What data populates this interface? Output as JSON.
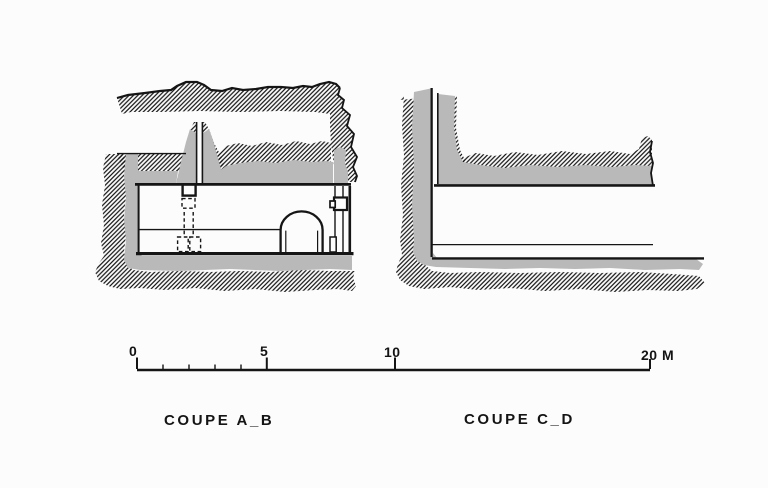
{
  "page": {
    "background": "#fcfcfc",
    "ink_color": "#151515",
    "masonry_gray": "#b9b9b9"
  },
  "figures": [
    {
      "caption": "COUPE A_B"
    },
    {
      "caption": "COUPE C_D"
    }
  ],
  "scale_bar": {
    "unit": "M",
    "labels": [
      "0",
      "5",
      "10",
      "20 M"
    ],
    "major_tick_values_m": [
      0,
      5,
      10,
      20
    ],
    "minor_tick_values_m": [
      1,
      2,
      3,
      4
    ],
    "total_length_m": 20
  }
}
